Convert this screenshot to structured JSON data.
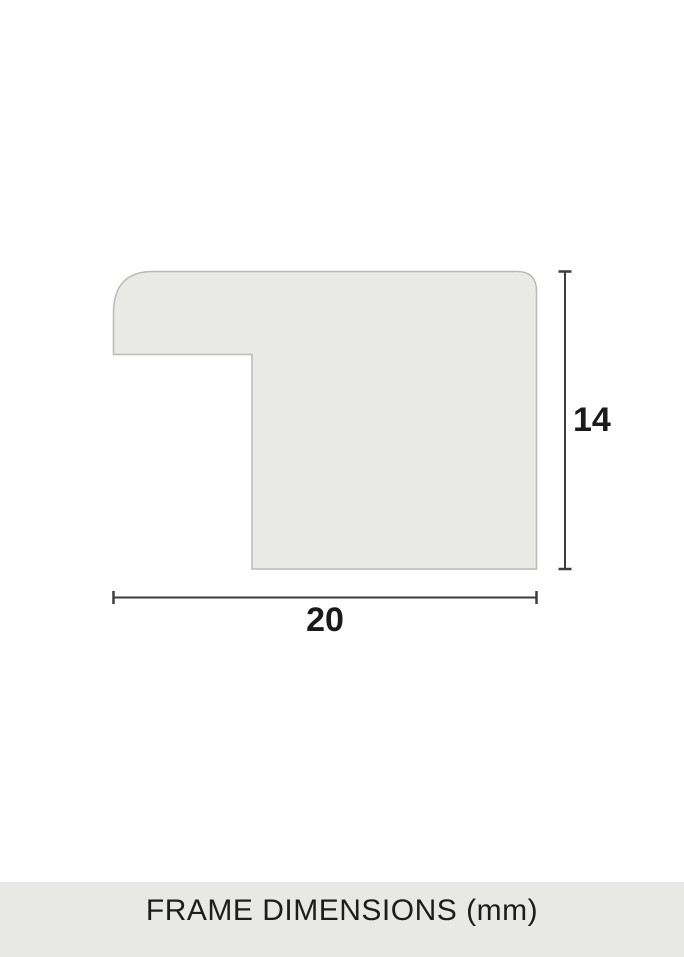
{
  "diagram": {
    "name": "frame-profile-cross-section",
    "shape": {
      "fill": "#e9e9e5",
      "stroke": "#b9b9b5"
    },
    "line_color": "#3d3d3d",
    "label_color": "#1a1a1a",
    "dimensions": {
      "height": {
        "label": "14"
      },
      "width": {
        "label": "20"
      }
    }
  },
  "footer": {
    "label": "FRAME DIMENSIONS (mm)",
    "background": "#e8e8e4",
    "text_color": "#1d1d1b"
  }
}
